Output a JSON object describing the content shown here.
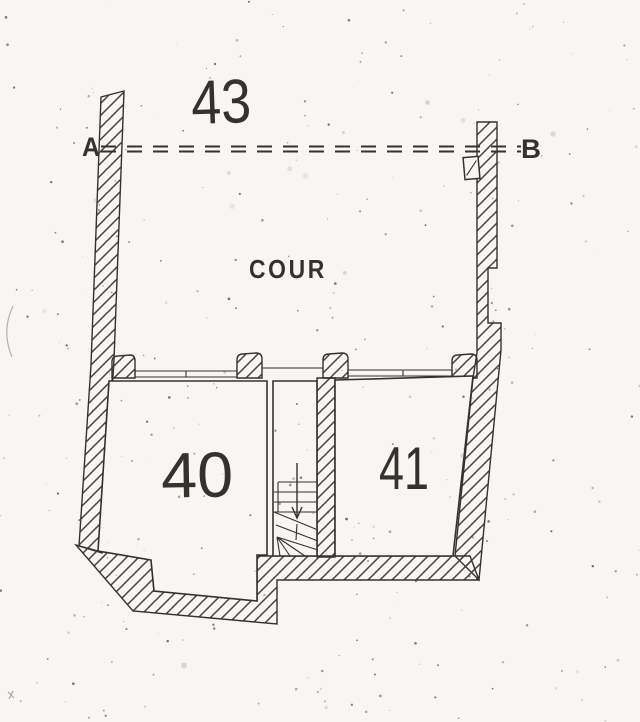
{
  "labels": {
    "parcel_number": "43",
    "section_marker_start": "A",
    "section_marker_end": "B",
    "courtyard": "COUR",
    "room_left": "40",
    "room_right": "41"
  },
  "colors": {
    "paper": "#f7f6f2",
    "ink": "#35322e",
    "hatch": "#45423d",
    "speckle": "#3c3c3c"
  }
}
